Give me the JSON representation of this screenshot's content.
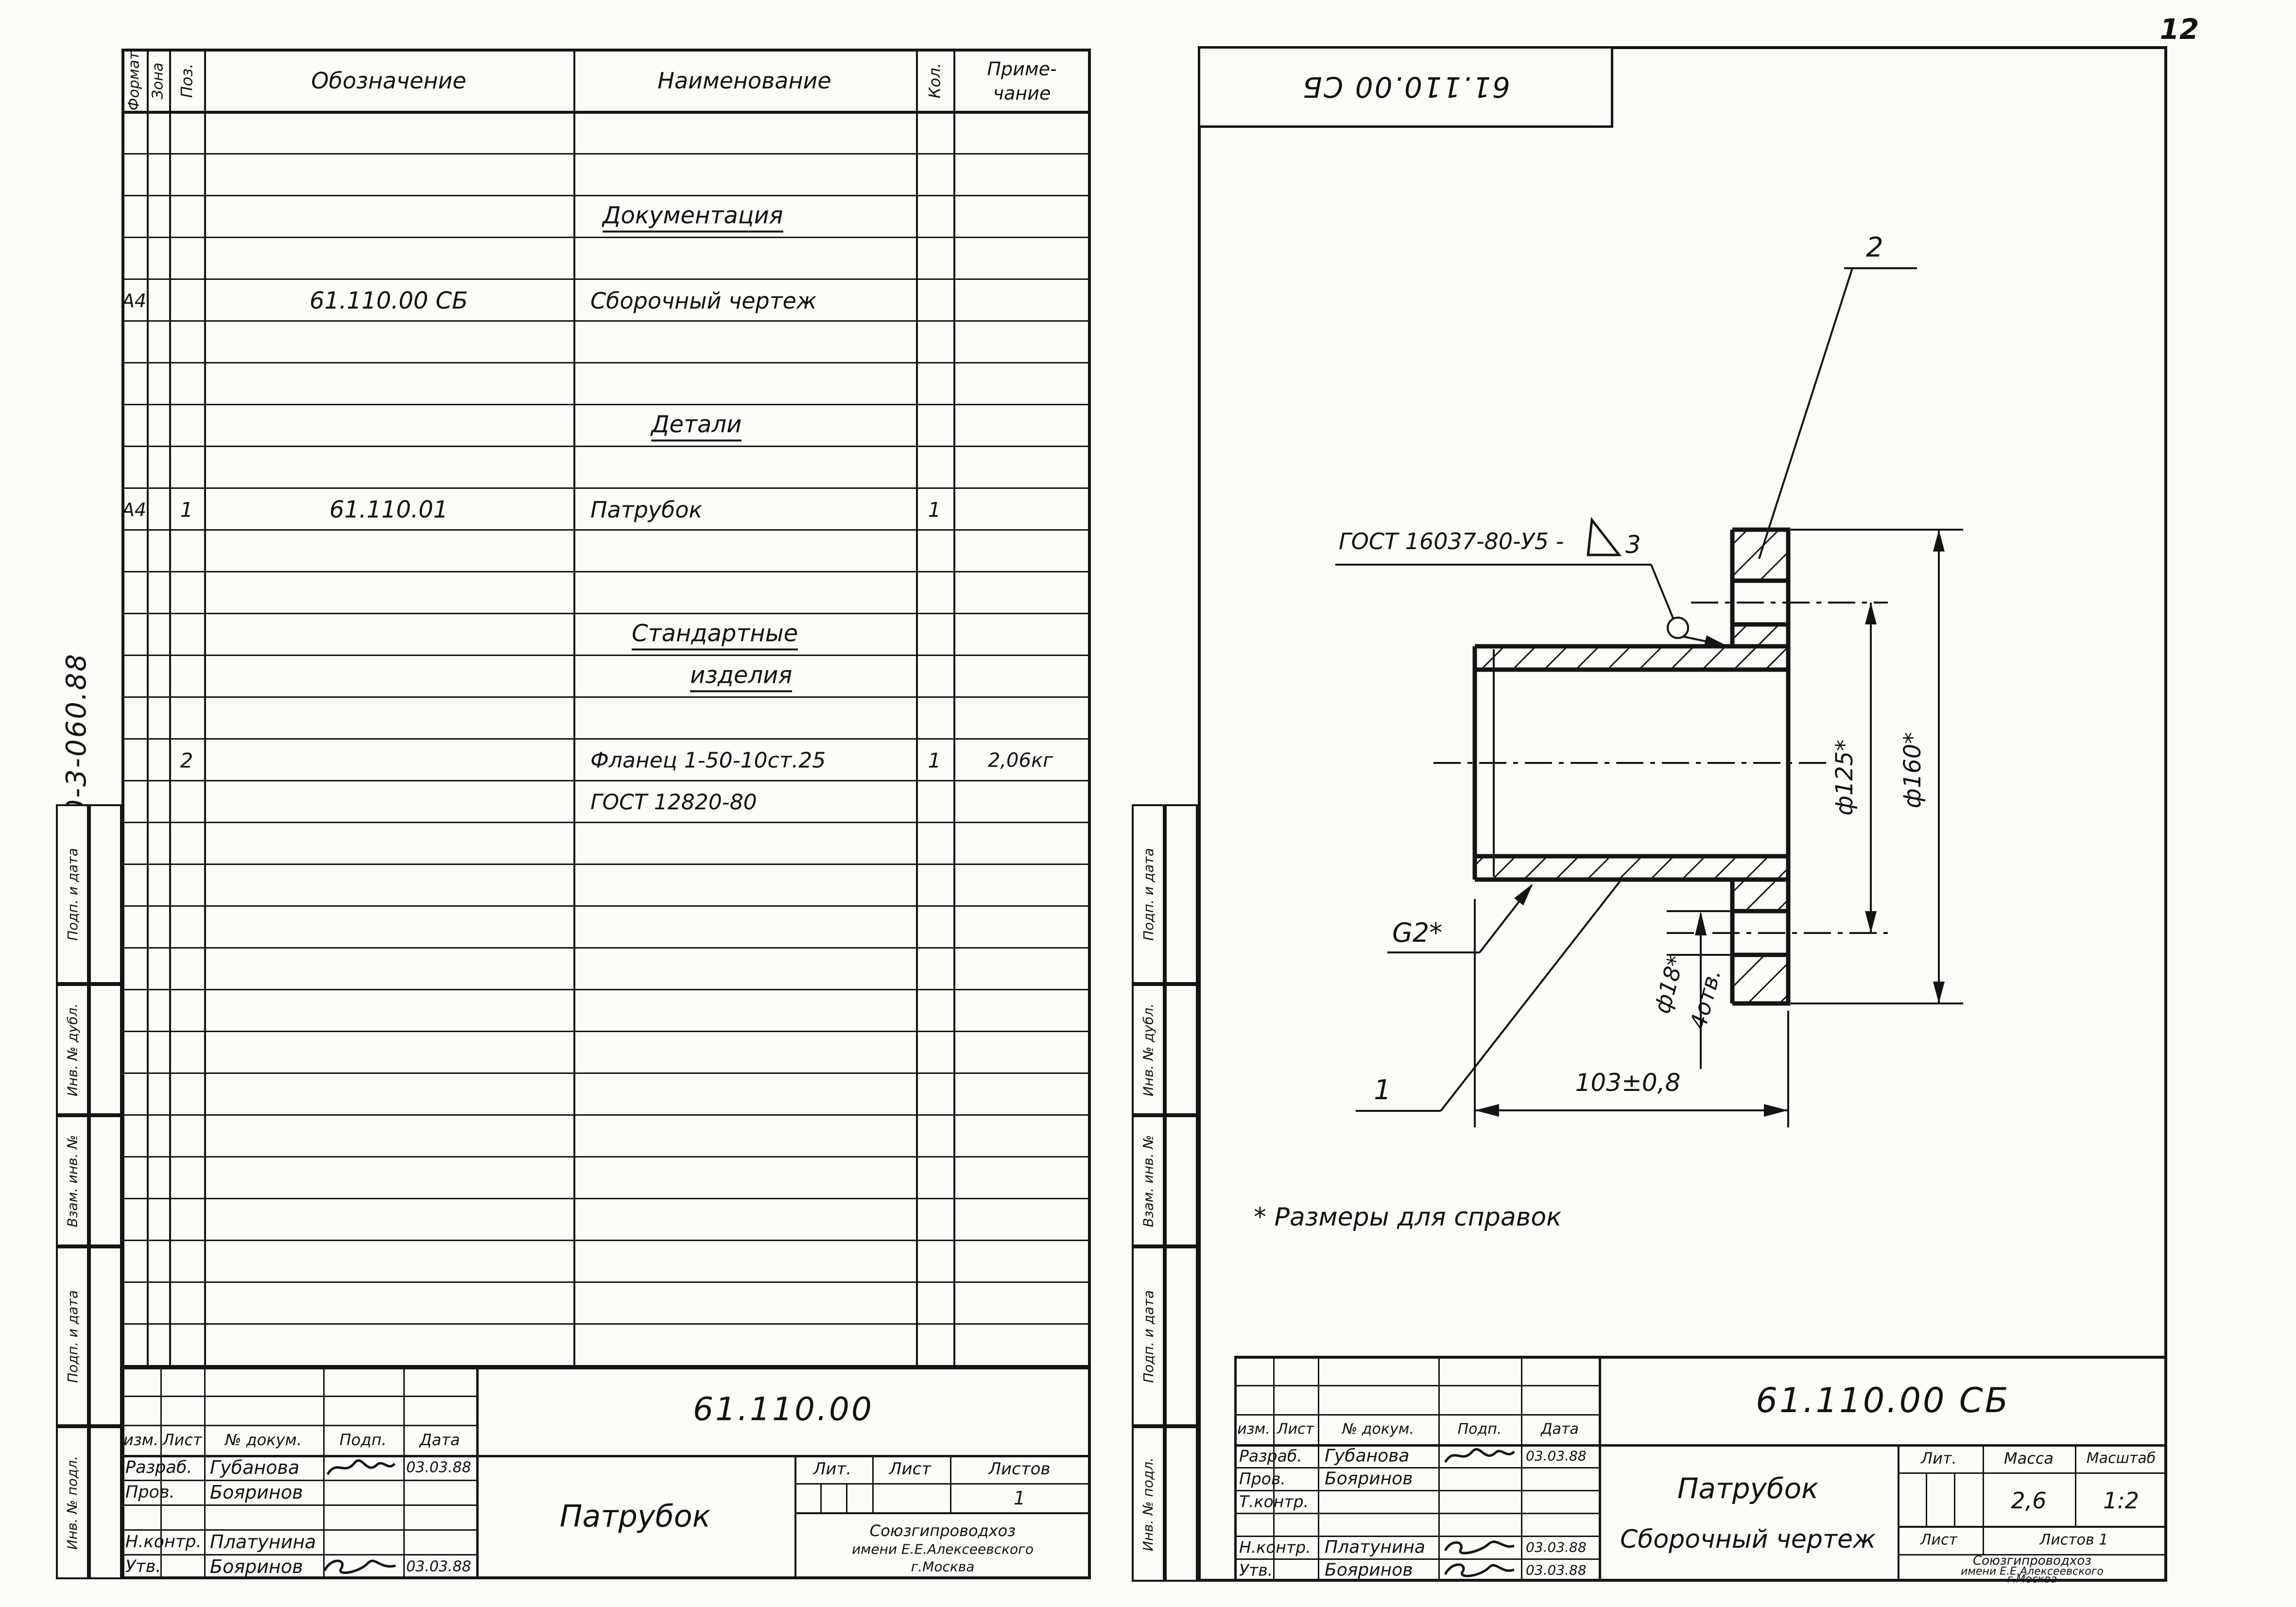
{
  "page_number": "12",
  "doc_code": "820-3-060.88",
  "stamp_top": "61.110.00 СБ",
  "note": "* Размеры для справок",
  "side_labels": {
    "s1": "Подп. и дата",
    "s2": "Инв. № дубл.",
    "s3": "Взам. инв. №",
    "s4": "Подп. и дата",
    "s5": "Инв. № подл."
  },
  "spec": {
    "h_format": "Формат",
    "h_zone": "Зона",
    "h_pos": "Поз.",
    "h_desig": "Обозначение",
    "h_name": "Наименование",
    "h_qty": "Кол.",
    "h_note1": "Приме-",
    "h_note2": "чание",
    "r3_name": "Документация",
    "r5_format": "А4",
    "r5_desig": "61.110.00 СБ",
    "r5_name": "Сборочный чертеж",
    "r8_name": "Детали",
    "r10_format": "А4",
    "r10_pos": "1",
    "r10_desig": "61.110.01",
    "r10_name": "Патрубок",
    "r10_qty": "1",
    "r13_name": "Стандартные",
    "r14_name": "изделия",
    "r16_pos": "2",
    "r16_name": "Фланец 1-50-10ст.25",
    "r16_qty": "1",
    "r16_note": "2,06кг",
    "r17_name": "ГОСТ 12820-80"
  },
  "tb_left": {
    "desig": "61.110.00",
    "title": "Патрубок",
    "h_izm": "изм.",
    "h_list": "Лист",
    "h_doc": "№ докум.",
    "h_sign": "Подп.",
    "h_date": "Дата",
    "razrab": "Разраб.",
    "razrab_name": "Губанова",
    "razrab_date": "03.03.88",
    "prov": "Пров.",
    "prov_name": "Бояринов",
    "nkontr": "Н.контр.",
    "nkontr_name": "Платунина",
    "utv": "Утв.",
    "utv_name": "Бояринов",
    "utv_date": "03.03.88",
    "lit": "Лит.",
    "list": "Лист",
    "listov": "Листов",
    "listov_val": "1",
    "org1": "Союзгипроводхоз",
    "org2": "имени Е.Е.Алексеевского",
    "org3": "г.Москва"
  },
  "tb_right": {
    "desig": "61.110.00 СБ",
    "title": "Патрубок",
    "subtitle": "Сборочный чертеж",
    "h_izm": "изм.",
    "h_list": "Лист",
    "h_doc": "№ докум.",
    "h_sign": "Подп.",
    "h_date": "Дата",
    "razrab": "Разраб.",
    "razrab_name": "Губанова",
    "razrab_date": "03.03.88",
    "prov": "Пров.",
    "prov_name": "Бояринов",
    "tkontr": "Т.контр.",
    "nkontr": "Н.контр.",
    "nkontr_name": "Платунина",
    "nkontr_date": "03.03.88",
    "utv": "Утв.",
    "utv_name": "Бояринов",
    "utv_date": "03.03.88",
    "lit": "Лит.",
    "massa": "Масса",
    "masshtab": "Масштаб",
    "massa_val": "2,6",
    "scale_val": "1:2",
    "list": "Лист",
    "listov": "Листов 1",
    "org1": "Союзгипроводхоз",
    "org2": "имени Е.Е.Алексеевского",
    "org3": "г.Москва"
  },
  "drawing": {
    "weld": "ГОСТ 16037-80-У5 -",
    "weld_grade": "3",
    "pos1": "1",
    "pos2": "2",
    "thread": "G2*",
    "len": "103±0,8",
    "hole": "ф18*",
    "holes": "4отв.",
    "circle": "ф125*",
    "od": "ф160*"
  }
}
